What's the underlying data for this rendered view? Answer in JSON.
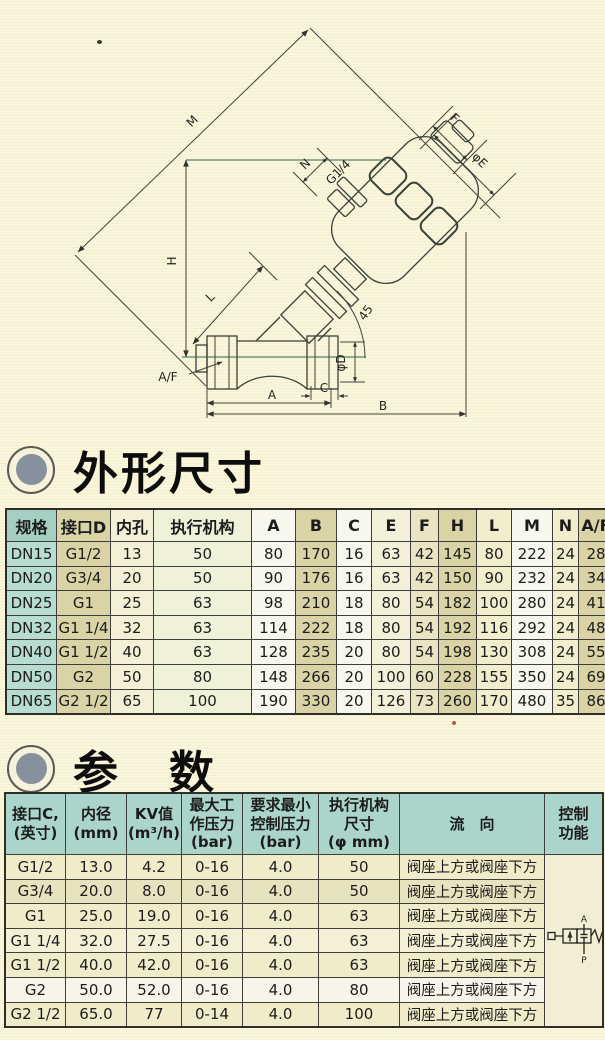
{
  "headings": {
    "outline": "外形尺寸",
    "params": "参　数"
  },
  "drawing": {
    "labels": {
      "m": "M",
      "f": "F",
      "phiE": "φE",
      "n": "N",
      "g14": "G1/4",
      "h": "H",
      "l": "L",
      "angle": "45",
      "af": "A/F",
      "phiD": "φD",
      "c": "C",
      "a": "A",
      "b": "B"
    }
  },
  "table1": {
    "columns": [
      "规格",
      "接口D",
      "内孔",
      "执行机构",
      "A",
      "B",
      "C",
      "E",
      "F",
      "H",
      "L",
      "M",
      "N",
      "A/F"
    ],
    "rows": [
      [
        "DN15",
        "G1/2",
        "13",
        "50",
        "80",
        "170",
        "16",
        "63",
        "42",
        "145",
        "80",
        "222",
        "24",
        "28"
      ],
      [
        "DN20",
        "G3/4",
        "20",
        "50",
        "90",
        "176",
        "16",
        "63",
        "42",
        "150",
        "90",
        "232",
        "24",
        "34"
      ],
      [
        "DN25",
        "G1",
        "25",
        "63",
        "98",
        "210",
        "18",
        "80",
        "54",
        "182",
        "100",
        "280",
        "24",
        "41"
      ],
      [
        "DN32",
        "G1 1/4",
        "32",
        "63",
        "114",
        "222",
        "18",
        "80",
        "54",
        "192",
        "116",
        "292",
        "24",
        "48"
      ],
      [
        "DN40",
        "G1 1/2",
        "40",
        "63",
        "128",
        "235",
        "20",
        "80",
        "54",
        "198",
        "130",
        "308",
        "24",
        "55"
      ],
      [
        "DN50",
        "G2",
        "50",
        "80",
        "148",
        "266",
        "20",
        "100",
        "60",
        "228",
        "155",
        "350",
        "24",
        "69"
      ],
      [
        "DN65",
        "G2 1/2",
        "65",
        "100",
        "190",
        "330",
        "20",
        "126",
        "73",
        "260",
        "170",
        "480",
        "35",
        "86"
      ]
    ]
  },
  "table2": {
    "columns": [
      "接口C,\n(英寸)",
      "内径\n(mm)",
      "KV值\n(m³/h)",
      "最大工\n作压力\n(bar)",
      "要求最小\n控制压力\n(bar)",
      "执行机构\n尺寸\n(φ mm)",
      "流　向",
      "控制\n功能"
    ],
    "rows": [
      [
        "G1/2",
        "13.0",
        "4.2",
        "0-16",
        "4.0",
        "50",
        "阀座上方或阀座下方"
      ],
      [
        "G3/4",
        "20.0",
        "8.0",
        "0-16",
        "4.0",
        "50",
        "阀座上方或阀座下方"
      ],
      [
        "G1",
        "25.0",
        "19.0",
        "0-16",
        "4.0",
        "63",
        "阀座上方或阀座下方"
      ],
      [
        "G1 1/4",
        "32.0",
        "27.5",
        "0-16",
        "4.0",
        "63",
        "阀座上方或阀座下方"
      ],
      [
        "G1 1/2",
        "40.0",
        "42.0",
        "0-16",
        "4.0",
        "63",
        "阀座上方或阀座下方"
      ],
      [
        "G2",
        "50.0",
        "52.0",
        "0-16",
        "4.0",
        "80",
        "阀座上方或阀座下方"
      ],
      [
        "G2 1/2",
        "65.0",
        "77",
        "0-14",
        "4.0",
        "100",
        "阀座上方或阀座下方"
      ]
    ],
    "symbol": {
      "port_top": "A",
      "port_bottom": "P"
    }
  }
}
